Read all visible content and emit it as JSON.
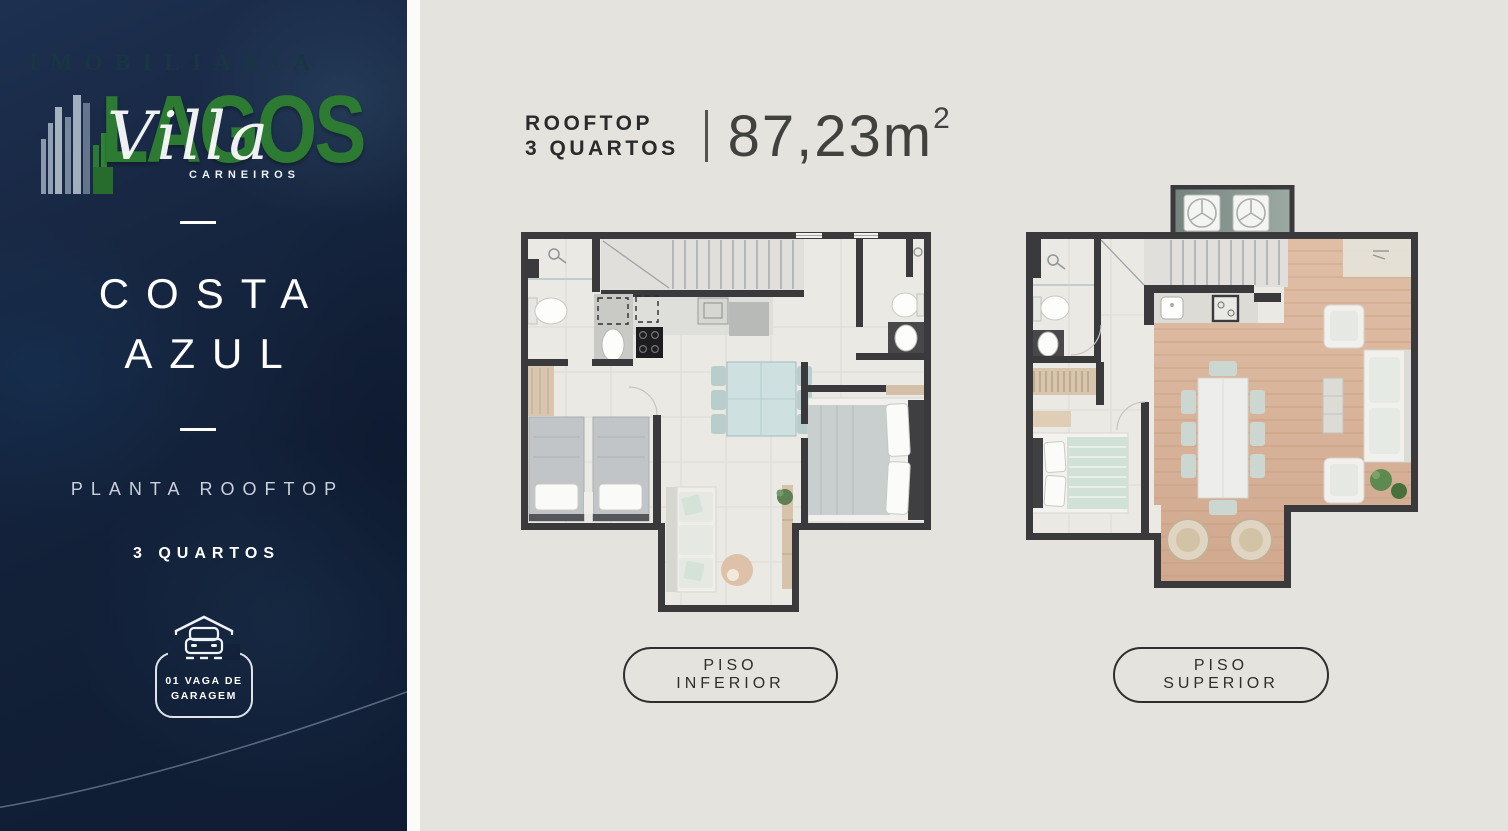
{
  "sidebar": {
    "watermark_imobiliaria": "IMOBILIÁRIA",
    "watermark_lagos": "LAGOS",
    "brand_script": "Villa",
    "brand_sub": "CARNEIROS",
    "title_line1": "COSTA",
    "title_line2": "AZUL",
    "plan_label": "PLANTA ROOFTOP",
    "bedrooms_label": "3 QUARTOS",
    "garage": {
      "line1": "01 VAGA DE",
      "line2": "GARAGEM"
    }
  },
  "header": {
    "title_line1": "ROOFTOP",
    "title_line2": "3 QUARTOS",
    "area_value": "87,23m",
    "area_exponent": "2"
  },
  "plans": [
    {
      "label": "PISO INFERIOR"
    },
    {
      "label": "PISO SUPERIOR"
    }
  ],
  "icons": {
    "building": "building-skyline-icon",
    "garage": "car-under-roof-icon"
  },
  "colors": {
    "sidebar_navy": "#16253f",
    "accent_green": "#2d7b33",
    "canvas": "#e4e3de",
    "wall": "#3a3a3d",
    "wood_floor": "#d6b199",
    "text_dark": "#2b2b2b"
  }
}
